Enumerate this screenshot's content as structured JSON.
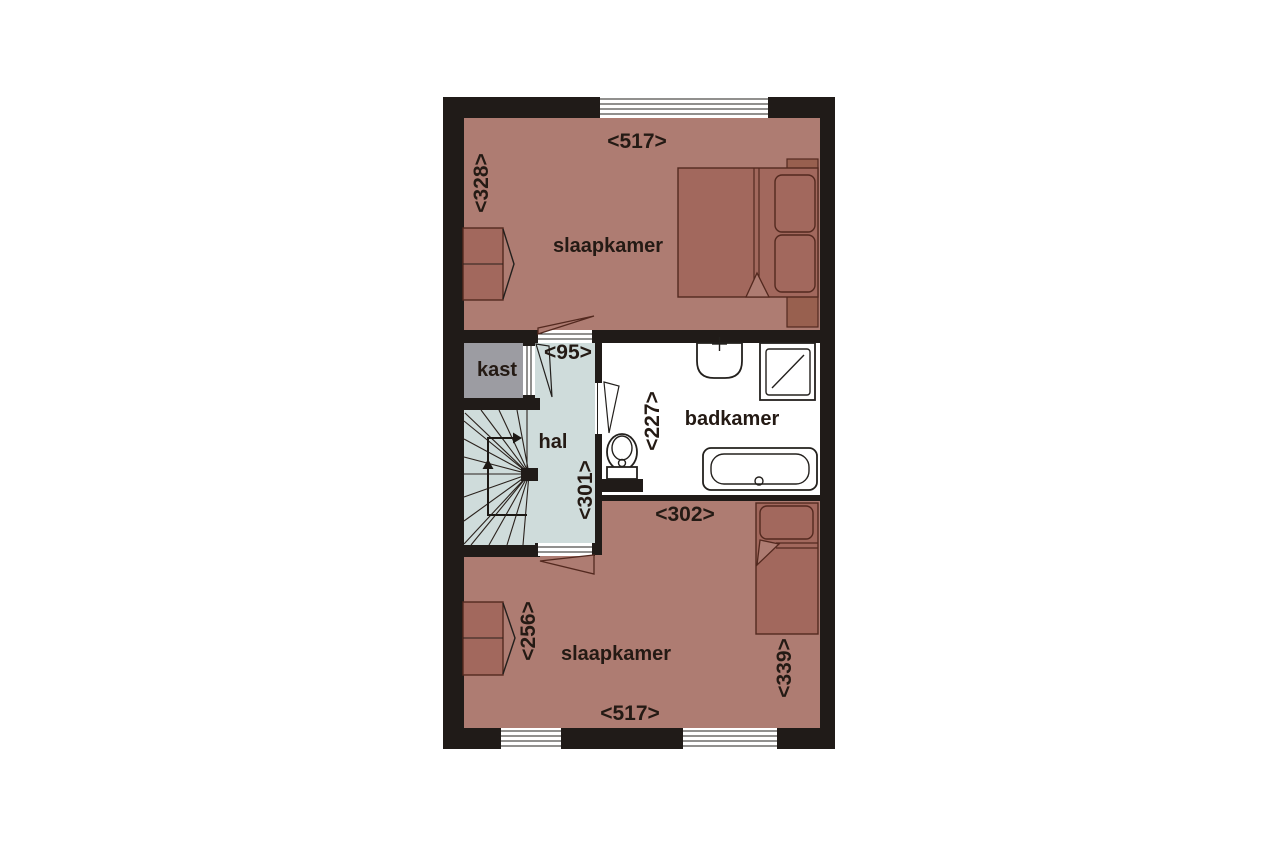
{
  "floorplan": {
    "title": "upper floor plan",
    "rooms": [
      {
        "id": "slaapkamer-top",
        "label": "slaapkamer"
      },
      {
        "id": "kast",
        "label": "kast"
      },
      {
        "id": "hal",
        "label": "hal"
      },
      {
        "id": "badkamer",
        "label": "badkamer"
      },
      {
        "id": "slaapkamer-bottom",
        "label": "slaapkamer"
      }
    ],
    "dimensions": [
      {
        "id": "top-room-width",
        "text": "<517>"
      },
      {
        "id": "top-room-height",
        "text": "<328>"
      },
      {
        "id": "hal-width",
        "text": "<95>"
      },
      {
        "id": "hal-height",
        "text": "<301>"
      },
      {
        "id": "badkamer-height",
        "text": "<227>"
      },
      {
        "id": "badkamer-width",
        "text": "<302>"
      },
      {
        "id": "closet-wall-height",
        "text": "<256>"
      },
      {
        "id": "bottom-room-right-height",
        "text": "<339>"
      },
      {
        "id": "bottom-room-width",
        "text": "<517>"
      }
    ],
    "furniture": [
      "wardrobe-top",
      "double-bed",
      "wardrobe-bottom",
      "single-bed"
    ],
    "fixtures": [
      "sink",
      "shower",
      "toilet",
      "bathtub",
      "winder-stairs"
    ],
    "colors": {
      "wall": "#201b18",
      "bedroom_floor": "#ae7c72",
      "hal_floor": "#cfdcdb",
      "kast_floor": "#9c9ca2",
      "bathroom_floor": "#ffffff",
      "furniture": "#a2685d",
      "text": "#241a14"
    }
  }
}
